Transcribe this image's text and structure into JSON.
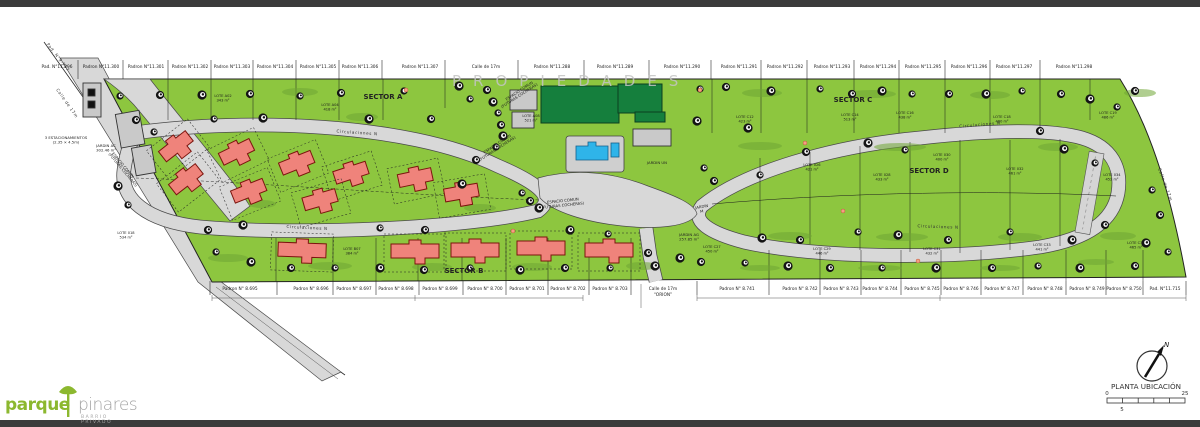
{
  "plan": {
    "watermark": "PROPIEDADES",
    "sector_labels": [
      {
        "text": "SECTOR A",
        "x": 383,
        "y": 99
      },
      {
        "text": "SECTOR B",
        "x": 464,
        "y": 273
      },
      {
        "text": "SECTOR C",
        "x": 853,
        "y": 102
      },
      {
        "text": "SECTOR D",
        "x": 929,
        "y": 173
      }
    ],
    "street_labels": [
      {
        "text": "Circulaciones N",
        "x": 357,
        "y": 134,
        "rot": 4
      },
      {
        "text": "Circulaciones N",
        "x": 307,
        "y": 229,
        "rot": 3
      },
      {
        "text": "Circulaciones N",
        "x": 980,
        "y": 126,
        "rot": -5
      },
      {
        "text": "Circulaciones N",
        "x": 938,
        "y": 228,
        "rot": 2
      },
      {
        "text": "Calle de 17m",
        "x": 1164,
        "y": 185,
        "rot": 70
      },
      {
        "text": "Pad. N°9.967",
        "x": 57,
        "y": 58,
        "rot": 52
      },
      {
        "text": "Calle de 17m",
        "x": 66,
        "y": 104,
        "rot": 55
      }
    ],
    "top_labels": [
      {
        "text": "Pad. N°11.296",
        "x": 57
      },
      {
        "text": "Padron N°11.300",
        "x": 101
      },
      {
        "text": "Padron N°11.301",
        "x": 146
      },
      {
        "text": "Padron N°11.302",
        "x": 190
      },
      {
        "text": "Padron N°11.303",
        "x": 232
      },
      {
        "text": "Padron N°11.304",
        "x": 275
      },
      {
        "text": "Padron N°11.305",
        "x": 318
      },
      {
        "text": "Padron N°11.306",
        "x": 360
      },
      {
        "text": "Padron N°11.307",
        "x": 420
      },
      {
        "text": "Calle de 17m",
        "x": 486
      },
      {
        "text": "Padron N°11.288",
        "x": 552
      },
      {
        "text": "Padron N°11.289",
        "x": 615
      },
      {
        "text": "Padron N°11.290",
        "x": 682
      },
      {
        "text": "Padron N°11.291",
        "x": 739
      },
      {
        "text": "Padron N°11.292",
        "x": 785
      },
      {
        "text": "Padron N°11.293",
        "x": 832
      },
      {
        "text": "Padron N°11.294",
        "x": 878
      },
      {
        "text": "Padron N°11.295",
        "x": 923
      },
      {
        "text": "Padron N°11.296",
        "x": 969
      },
      {
        "text": "Padron N°11.297",
        "x": 1014
      },
      {
        "text": "Padron N°11.298",
        "x": 1074
      }
    ],
    "bottom_labels": [
      {
        "text": "Padron N° 8.695",
        "x": 240
      },
      {
        "text": "Padron N° 8.696",
        "x": 311
      },
      {
        "text": "Padron N° 8.697",
        "x": 354
      },
      {
        "text": "Padron N° 8.698",
        "x": 396
      },
      {
        "text": "Padron N° 8.699",
        "x": 440
      },
      {
        "text": "Padron N° 8.700",
        "x": 485
      },
      {
        "text": "Padron N° 8.701",
        "x": 527
      },
      {
        "text": "Padron N° 8.702",
        "x": 568
      },
      {
        "text": "Padron N° 8.703",
        "x": 610
      },
      {
        "text": "Calle de 17m",
        "text2": "“ORION”",
        "x": 663
      },
      {
        "text": "Padron N° 8.741",
        "x": 737
      },
      {
        "text": "Padron N° 8.742",
        "x": 800
      },
      {
        "text": "Padron N° 8.743",
        "x": 841
      },
      {
        "text": "Padron N° 8.744",
        "x": 880
      },
      {
        "text": "Padron N° 8.745",
        "x": 922
      },
      {
        "text": "Padron N° 8.746",
        "x": 961
      },
      {
        "text": "Padron N° 8.747",
        "x": 1002
      },
      {
        "text": "Padron N° 8.748",
        "x": 1045
      },
      {
        "text": "Padron N° 8.749",
        "x": 1087
      },
      {
        "text": "Padron N° 8.750",
        "x": 1124
      },
      {
        "text": "Pad. N°11.715",
        "x": 1165
      }
    ],
    "annotations": [
      {
        "text": "JARDIN UN",
        "x": 657,
        "y": 164
      },
      {
        "text": "JARDIN",
        "text2": "M",
        "x": 702,
        "y": 208,
        "rot": -10
      },
      {
        "text": "JARDIN AG",
        "text2": "257.85 m²",
        "x": 689,
        "y": 236
      },
      {
        "text": "JARDIN AC",
        "text2": "302.46 m²",
        "x": 106,
        "y": 147
      },
      {
        "text": "3 ESTACIONAMIENTOS",
        "text2": "(2.35 × 4.5m)",
        "x": 66,
        "y": 139
      },
      {
        "text": "ESPACIO COMUN",
        "text2": "(FUTURAS COCHERAS)",
        "x": 520,
        "y": 92,
        "rot": -33
      },
      {
        "text": "ESPACIO COMUN",
        "text2": "(FUTURAS COCHERAS)",
        "x": 498,
        "y": 145,
        "rot": -33
      },
      {
        "text": "ESPACIO COMUN",
        "text2": "(FUTURAS COCHERAS)",
        "x": 563,
        "y": 202,
        "rot": -6
      },
      {
        "text": "ESPACIO COMUN",
        "text2": "(FUTURAS COCHERAS)",
        "x": 122,
        "y": 166,
        "rot": 50
      }
    ],
    "lots": [
      {
        "name": "LOTE A02",
        "area": "343 m²",
        "x": 223,
        "y": 97
      },
      {
        "name": "LOTE A04",
        "area": "418 m²",
        "x": 330,
        "y": 106
      },
      {
        "name": "LOTE A08",
        "area": "521 m²",
        "x": 531,
        "y": 117
      },
      {
        "name": "LOTE C12",
        "area": "423 m²",
        "x": 745,
        "y": 118
      },
      {
        "name": "LOTE C14",
        "area": "513 m²",
        "x": 850,
        "y": 116
      },
      {
        "name": "LOTE C16",
        "area": "438 m²",
        "x": 905,
        "y": 114
      },
      {
        "name": "LOTE C18",
        "area": "480 m²",
        "x": 1002,
        "y": 118
      },
      {
        "name": "LOTE C19",
        "area": "486 m²",
        "x": 1108,
        "y": 114
      },
      {
        "name": "LOTE 026",
        "area": "421 m²",
        "x": 812,
        "y": 166
      },
      {
        "name": "LOTE 028",
        "area": "433 m²",
        "x": 882,
        "y": 176
      },
      {
        "name": "LOTE 030",
        "area": "400 m²",
        "x": 942,
        "y": 156
      },
      {
        "name": "LOTE 032",
        "area": "461 m²",
        "x": 1015,
        "y": 170
      },
      {
        "name": "LOTE 034",
        "area": "452 m²",
        "x": 1112,
        "y": 176
      },
      {
        "name": "LOTE C27",
        "area": "450 m²",
        "x": 712,
        "y": 248
      },
      {
        "name": "LOTE C29",
        "area": "446 m²",
        "x": 822,
        "y": 250
      },
      {
        "name": "LOTE C31",
        "area": "432 m²",
        "x": 932,
        "y": 250
      },
      {
        "name": "LOTE C33",
        "area": "441 m²",
        "x": 1042,
        "y": 246
      },
      {
        "name": "LOTE C35",
        "area": "465 m²",
        "x": 1136,
        "y": 244
      },
      {
        "name": "LOTE B07",
        "area": "384 m²",
        "x": 352,
        "y": 250
      },
      {
        "name": "LOTE 018",
        "area": "534 m²",
        "x": 126,
        "y": 234
      }
    ],
    "legend": {
      "title": "PLANTA UBICACIÓN",
      "north_label": "N",
      "scale_start": "0",
      "scale_end": "25",
      "scale_sub": "5"
    },
    "logo": {
      "word1": "parque",
      "word2": "pinares",
      "subtitle": "BARRIO PRIVADO"
    },
    "colors": {
      "site_green": "#8dc63f",
      "club_green": "#157f3d",
      "road_gray": "#d8d8d8",
      "house_red": "#ef837b",
      "pool_blue": "#2fb4e9",
      "logo_green": "#8cb82f"
    }
  }
}
